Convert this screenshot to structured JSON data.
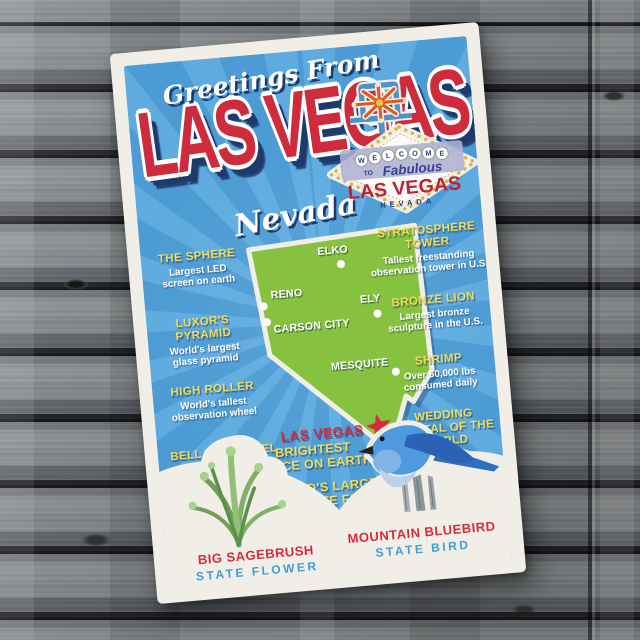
{
  "colors": {
    "wood_gray": "#7b7e80",
    "paper": "#f1eee8",
    "card_blue": "#4c9bd4",
    "ray_blue": "#5fabdf",
    "title_red": "#ce2b3d",
    "navy": "#1e3a6b",
    "yellow": "#f2dc55",
    "map_green": "#86c23f",
    "label_red": "#d42c3c",
    "caption_blue": "#3e9fd8",
    "sign_red": "#be2136",
    "lavender": "#afb0d4",
    "gold": "#d9b23a",
    "orange": "#e05a1e"
  },
  "postcard": {
    "greeting": "Greetings From",
    "title": "LAS VEGAS",
    "subtitle": "Nevada",
    "sign": {
      "letters": [
        "W",
        "E",
        "L",
        "C",
        "O",
        "M",
        "E"
      ],
      "to": "TO",
      "fabulous": "Fabulous",
      "city": "LAS VEGAS",
      "state": "NEVADA"
    },
    "map": {
      "cities": [
        {
          "name": "ELKO"
        },
        {
          "name": "RENO"
        },
        {
          "name": "CARSON CITY"
        },
        {
          "name": "ELY"
        },
        {
          "name": "MESQUITE"
        }
      ],
      "highlight": "LAS VEGAS"
    },
    "facts_left": [
      {
        "title": "THE SPHERE",
        "desc": "Largest LED\nscreen on earth"
      },
      {
        "title": "LUXOR'S\nPYRAMID",
        "desc": "World's largest\nglass pyramid"
      },
      {
        "title": "HIGH ROLLER",
        "desc": "World's tallest\nobservation wheel"
      },
      {
        "title": "BELLAGIO HOTEL",
        "desc": "Over 1,200 fountains"
      }
    ],
    "facts_right": [
      {
        "title": "STRATOSPHERE\nTOWER",
        "desc": "Tallest freestanding\nobservation tower in U.S."
      },
      {
        "title": "BRONZE LION",
        "desc": "Largest bronze\nsculpture in the U.S."
      },
      {
        "title": "SHRIMP",
        "desc": "Over 60,000 lbs\nconsumed daily"
      },
      {
        "title": "WEDDING\nCAPITAL OF THE\nWORLD",
        "desc": ""
      }
    ],
    "bottom_facts": [
      "BRIGHTEST\nPLACE ON EARTH",
      "WORLD'S LARGEST\nCHOCOLATE FOUNTAIN"
    ],
    "country": {
      "line1": "UNITED STATES",
      "line2": "of AMERICA"
    },
    "state_flower": {
      "name": "BIG SAGEBRUSH",
      "label": "STATE FLOWER"
    },
    "state_bird": {
      "name": "MOUNTAIN BLUEBIRD",
      "label": "STATE BIRD"
    }
  }
}
